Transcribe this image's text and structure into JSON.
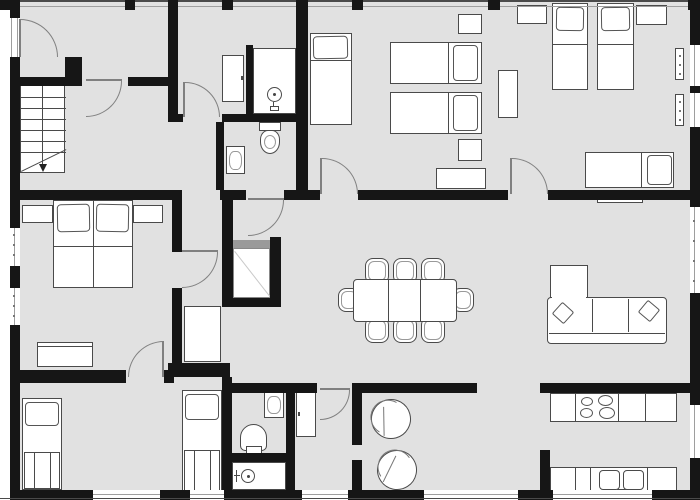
{
  "meta": {
    "kind": "architectural-floor-plan",
    "view": "top-down 2D apartment plan",
    "visible_text": "none"
  },
  "colors": {
    "paper": "#ffffff",
    "floor": "#e1e1e1",
    "wall": "#161616",
    "outline": "#4a4a4a",
    "door": "#808080",
    "glass": "#9e9e9e",
    "elevator_door": "#9a9a9a"
  },
  "rooms": [
    {
      "id": "entry-hall",
      "features": [
        "entry-door",
        "staircase-landing"
      ]
    },
    {
      "id": "stair-hall",
      "features": [
        "staircase-down"
      ]
    },
    {
      "id": "hall-with-cabinet",
      "features": [
        "cabinet",
        "shower-stall"
      ]
    },
    {
      "id": "wc-top",
      "features": [
        "toilet",
        "washbasin"
      ]
    },
    {
      "id": "bedroom-top-middle",
      "features": [
        "single-bed",
        "twin-beds",
        "nightstands",
        "desk"
      ]
    },
    {
      "id": "bedroom-top-right",
      "features": [
        "twin-beds",
        "single-bed",
        "wardrobe",
        "nightstands",
        "radiators"
      ]
    },
    {
      "id": "bedroom-left",
      "features": [
        "double-bed",
        "nightstands",
        "dresser"
      ]
    },
    {
      "id": "vestibule",
      "features": [
        "wardrobe"
      ]
    },
    {
      "id": "elevator",
      "features": [
        "elevator-cab",
        "elevator-door"
      ]
    },
    {
      "id": "bedroom-bottom-left",
      "features": [
        "single-bed",
        "single-bed"
      ]
    },
    {
      "id": "bathroom-bottom",
      "features": [
        "toilet",
        "washbasin",
        "shower-stall"
      ]
    },
    {
      "id": "living-dining",
      "features": [
        "dining-table",
        "eight-chairs",
        "corner-sofa",
        "tv-board",
        "tub-chairs"
      ]
    },
    {
      "id": "kitchen",
      "features": [
        "stove-4-burners",
        "double-sink",
        "counters"
      ]
    }
  ],
  "furniture_counts": {
    "beds": 9,
    "dining_chairs": 8,
    "tub_chairs": 2,
    "sofas": 1,
    "toilets": 2,
    "showers": 2,
    "washbasins": 2,
    "wardrobes_cabinets": 5,
    "staircases": 1,
    "elevators": 1
  }
}
